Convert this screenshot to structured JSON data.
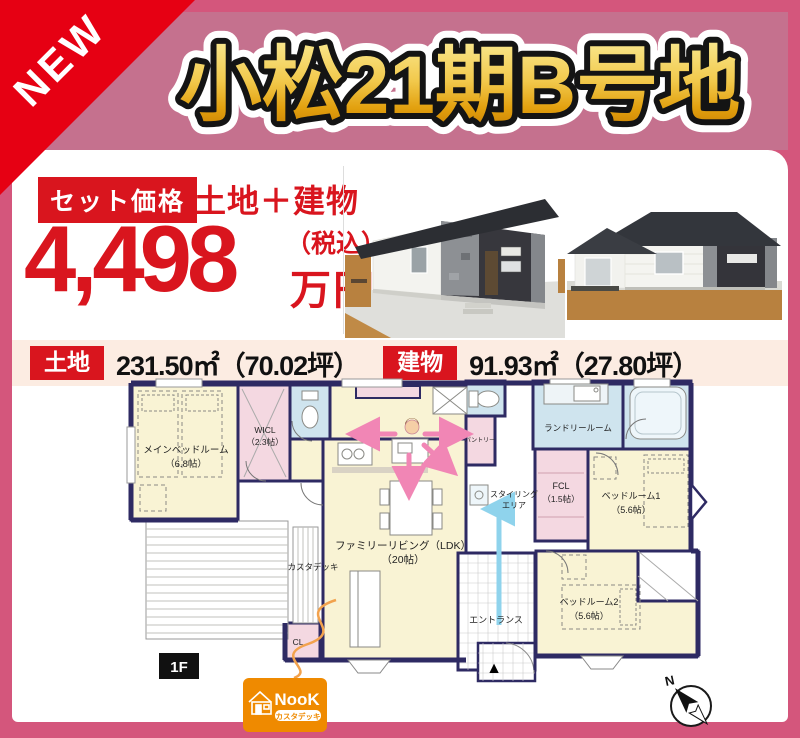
{
  "badge": {
    "label": "NEW"
  },
  "title": "小松21期B号地",
  "price": {
    "set_label": "セット価格",
    "combo_label": "土地＋建物",
    "amount": "4,498",
    "tax_note": "（税込）",
    "unit": "万円"
  },
  "area_row": {
    "land_label": "土地",
    "land_value": "231.50㎡（70.02坪）",
    "building_label": "建物",
    "building_value": "91.93㎡（27.80坪）"
  },
  "floor_plan": {
    "floor_label": "1F",
    "compass_n": "N",
    "entrance_marker": "▲",
    "rooms": {
      "main_bedroom": {
        "name": "メインベッドルーム",
        "size": "（6.8帖）"
      },
      "wicl": {
        "name": "WICL",
        "size": "（2.3帖）"
      },
      "living": {
        "name": "ファミリーリビング（LDK）",
        "size": "（20帖）"
      },
      "pantry": {
        "name": "パントリー"
      },
      "laundry": {
        "name": "ランドリールーム"
      },
      "fcl": {
        "name": "FCL",
        "size": "（1.5帖）"
      },
      "styling": {
        "line1": "スタイリング",
        "line2": "エリア"
      },
      "bedroom1": {
        "name": "ベッドルーム1",
        "size": "（5.6帖）"
      },
      "bedroom2": {
        "name": "ベッドルーム2",
        "size": "（5.6帖）"
      },
      "entrance": "エントランス",
      "deck": "カスタデッキ",
      "closet": "CL"
    }
  },
  "logo": {
    "name": "NooK",
    "tagline": "カスタデッキ"
  },
  "icons": {
    "new_ribbon": "corner-ribbon",
    "compass": "compass-rose",
    "entrance_marker": "black-triangle",
    "logo_house": "house-icon"
  },
  "colors": {
    "frame_pink": "#d4567c",
    "band_pink": "#c5718e",
    "accent_red": "#d9151e",
    "title_gold": "#e8a80c",
    "row_peach": "#fcece2",
    "plan_wall_navy": "#2e2a63",
    "room_cream": "#f9f3d4",
    "room_pink": "#f4d8e1",
    "room_blue": "#cfe4ee",
    "arrow_pink": "#f186b5",
    "arrow_blue": "#8fd3ec",
    "logo_orange": "#ef8a00"
  }
}
